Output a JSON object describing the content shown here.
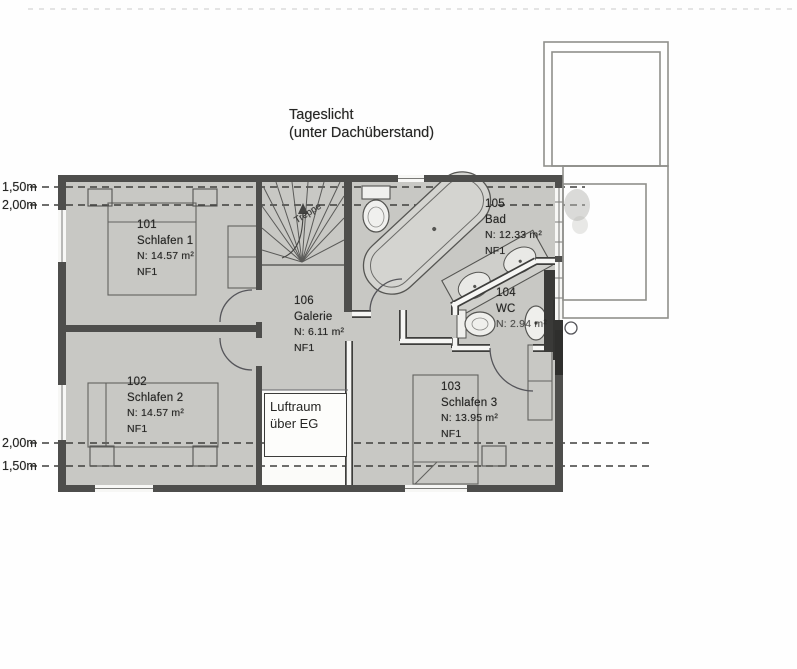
{
  "title": {
    "line1": "Tageslicht",
    "line2": "(unter Dachüberstand)"
  },
  "dimension_marks": {
    "top_first": "1,50m",
    "top_second": "2,00m",
    "bottom_first": "2,00m",
    "bottom_second": "1,50m"
  },
  "rooms": [
    {
      "number": "101",
      "name": "Schlafen 1",
      "area": "N: 14.57 m²",
      "nf": "NF1"
    },
    {
      "number": "102",
      "name": "Schlafen 2",
      "area": "N: 14.57 m²",
      "nf": "NF1"
    },
    {
      "number": "103",
      "name": "Schlafen 3",
      "area": "N: 13.95 m²",
      "nf": "NF1"
    },
    {
      "number": "104",
      "name": "WC",
      "area": "N: 2.94 m²",
      "nf": ""
    },
    {
      "number": "105",
      "name": "Bad",
      "area": "N: 12.33 m²",
      "nf": "NF1"
    },
    {
      "number": "106",
      "name": "Galerie",
      "area": "N: 6.11 m²",
      "nf": "NF1"
    }
  ],
  "void_label": {
    "line1": "Luftraum",
    "line2": "über EG"
  },
  "stair_label": "Treppe",
  "colors": {
    "paper": "#fefefe",
    "floor": "#c8c8c4",
    "wall": "#4e4e4c",
    "line": "#555553"
  }
}
